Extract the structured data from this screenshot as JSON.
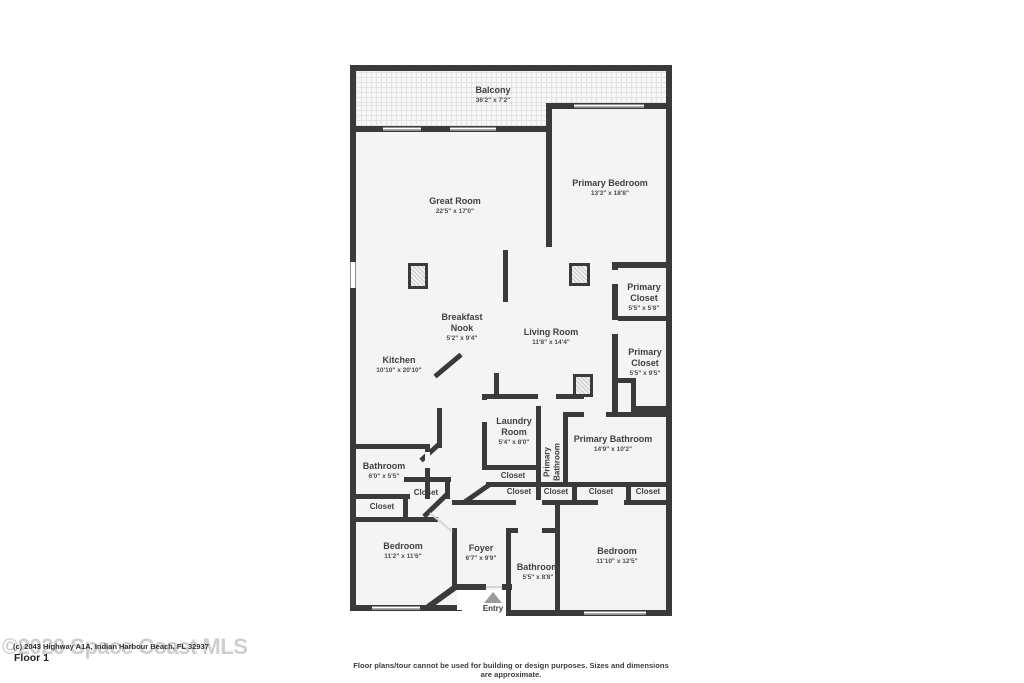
{
  "colors": {
    "wall": "#3a3a3a",
    "floor_fill": "#f4f4f4",
    "label_text": "#3f3f3f",
    "watermark": "#c6c6c6"
  },
  "watermark_text": "©2020 Space Coast MLS",
  "address_line": "(c) 2043 Highway A1A, Indian Harbour Beach, FL 32937",
  "floor_label": "Floor 1",
  "disclaimer": "Floor plans/tour cannot be used for building or design purposes. Sizes and dimensions are approximate.",
  "entry": {
    "label": "Entry"
  },
  "rooms": [
    {
      "name": "Balcony",
      "dims": "36'2\" x 7'2\""
    },
    {
      "name": "Great Room",
      "dims": "22'5\" x 17'0\""
    },
    {
      "name": "Primary Bedroom",
      "dims": "13'3\" x 18'8\""
    },
    {
      "name": "Primary Closet",
      "dims": "5'5\" x 5'8\""
    },
    {
      "name": "Primary Closet",
      "dims": "5'5\" x 9'5\""
    },
    {
      "name": "Breakfast Nook",
      "dims": "5'2\" x 9'4\""
    },
    {
      "name": "Living Room",
      "dims": "11'8\" x 14'4\""
    },
    {
      "name": "Kitchen",
      "dims": "10'10\" x 20'10\""
    },
    {
      "name": "Laundry Room",
      "dims": "5'4\" x 8'0\""
    },
    {
      "name": "Primary Bathroom",
      "dims": ""
    },
    {
      "name": "Primary Bathroom",
      "dims": "14'9\" x 10'2\""
    },
    {
      "name": "Bathroom",
      "dims": "6'0\" x 5'5\""
    },
    {
      "name": "Bedroom",
      "dims": "11'2\" x 11'6\""
    },
    {
      "name": "Foyer",
      "dims": "6'7\" x 9'9\""
    },
    {
      "name": "Bathroom",
      "dims": "5'5\" x 8'8\""
    },
    {
      "name": "Bedroom",
      "dims": "11'10\" x 12'5\""
    },
    {
      "name": "Closet",
      "dims": ""
    },
    {
      "name": "Closet",
      "dims": ""
    },
    {
      "name": "Closet",
      "dims": ""
    },
    {
      "name": "Closet",
      "dims": ""
    },
    {
      "name": "Closet",
      "dims": ""
    },
    {
      "name": "Closet",
      "dims": ""
    },
    {
      "name": "Closet",
      "dims": ""
    }
  ]
}
